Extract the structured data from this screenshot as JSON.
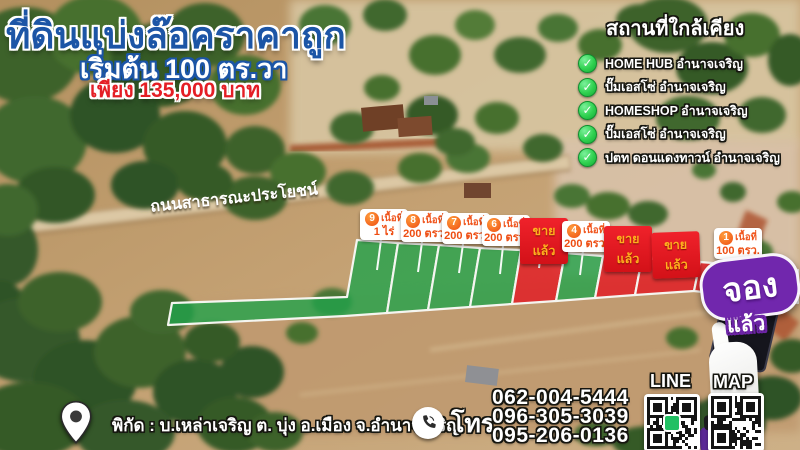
{
  "header": {
    "title": "ที่ดินแบ่งล๊อคราคาถูก",
    "subtitle": "เริ่มต้น 100 ตร.วา",
    "price": "เพียง 135,000 บาท"
  },
  "nearby": {
    "title": "สถานที่ใกล้เคียง",
    "check_glyph": "✓",
    "items": [
      "HOME HUB อำนาจเจริญ",
      "ปั๊มเอสโซ่ อำนาจเจริญ",
      "HOMESHOP อำนาจเจริญ",
      "ปั๊มเอสโซ่ อำนาจเจริญ",
      "ปตท ดอนแดงทาวน์ อำนาจเจริญ"
    ]
  },
  "road_label": "ถนนสาธารณะประโยชน์",
  "plots": [
    {
      "number": "9",
      "area_label": "เนื้อที่",
      "area_value": "1 ไร่",
      "status": "available"
    },
    {
      "number": "8",
      "area_label": "เนื้อที่",
      "area_value": "200 ตรว.",
      "status": "available"
    },
    {
      "number": "7",
      "area_label": "เนื้อที่",
      "area_value": "200 ตรว.",
      "status": "available"
    },
    {
      "number": "6",
      "area_label": "เนื้อที่",
      "area_value": "200 ตรว.",
      "status": "available"
    },
    {
      "label": "ขายแล้ว",
      "status": "sold"
    },
    {
      "number": "4",
      "area_label": "เนื้อที่",
      "area_value": "200 ตรว.",
      "status": "available"
    },
    {
      "label": "ขายแล้ว",
      "status": "sold"
    },
    {
      "label": "ขายแล้ว",
      "status": "sold"
    },
    {
      "number": "1",
      "area_label": "เนื้อที่",
      "area_value": "100 ตรว.",
      "status": "reserved"
    }
  ],
  "reserved_badge": {
    "line1": "จอง",
    "line2": "แล้ว"
  },
  "footer": {
    "location": "พิกัด : บ.เหล่าเจริญ ต. บุ่ง อ.เมือง จ.อำนาจเจริญ",
    "phone_label": "โทร",
    "phones": [
      "062-004-5444",
      "096-305-3039",
      "095-206-0136"
    ],
    "line_label": "LINE",
    "map_label": "MAP"
  },
  "colors": {
    "title_blue": "#1c55a6",
    "price_red": "#e41e25",
    "plot_green": "#22a24b",
    "plot_red": "#e01e26",
    "label_orange": "#ee4d12",
    "sold_text": "#ffaf1e",
    "check_green": "#2fd14f",
    "reserved_purple": "#7127ad"
  }
}
